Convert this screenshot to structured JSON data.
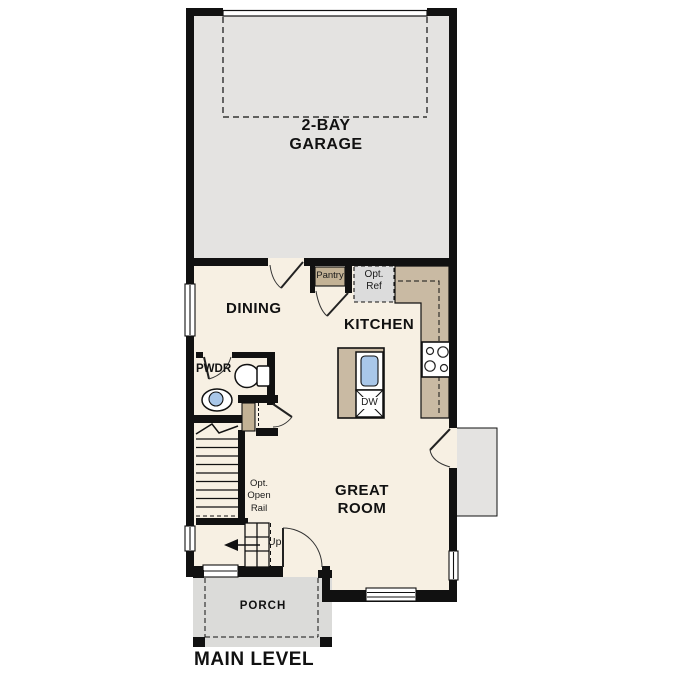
{
  "title": "MAIN LEVEL",
  "rooms": {
    "garage": "2-BAY\nGARAGE",
    "dining": "DINING",
    "kitchen": "KITCHEN",
    "great_room": "GREAT\nROOM",
    "powder": "PWDR",
    "porch": "PORCH"
  },
  "labels": {
    "pantry": "Pantry",
    "opt_ref": "Opt.\nRef",
    "dishwasher": "DW",
    "up": "Up",
    "opt_open_rail": "Opt.\nOpen\nRail"
  },
  "fixtures": [
    "garage-door",
    "parking-bays-dashed",
    "entry-door",
    "garage-entry-door",
    "pantry-door",
    "powder-door",
    "patio-door",
    "closet-door",
    "toilet",
    "vanity-sink",
    "kitchen-island",
    "kitchen-sink",
    "dishwasher",
    "cooktop",
    "optional-refrigerator",
    "stairs-up",
    "winder-steps",
    "windows",
    "rear-patio-pad"
  ],
  "colors": {
    "walls": "#111111",
    "floor": "#f7f0e3",
    "garage_floor": "#e4e3e1",
    "porch_floor": "#dbdbd9",
    "counter_tan": "#c9baa3",
    "cabinet_tan": "#c3b295",
    "sink_water": "#a9c7e9",
    "opt_ref_fill": "#dcdcdc"
  }
}
